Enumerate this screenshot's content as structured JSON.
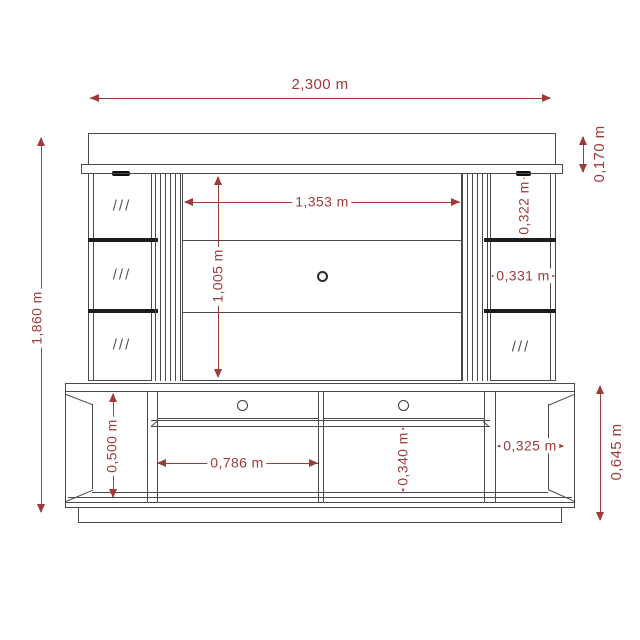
{
  "drawing": {
    "subject": "TV wall unit / entertainment center elevation drawing",
    "units": "m"
  },
  "colors": {
    "dimension": "#9d3a3a",
    "line": "#4a4a4a",
    "shelf_dark": "#1c1c1c",
    "background": "#ffffff"
  },
  "marks": {
    "glass_hatch": "///"
  },
  "dimensions": {
    "total_width": "2,300 m",
    "total_height": "1,860 m",
    "crown_height": "0,170 m",
    "right_upper_section_height": "0,322 m",
    "right_middle_section_width": "0,331 m",
    "panel_width": "1,353 m",
    "panel_height": "1,005 m",
    "cabinet_interior_height": "0,500 m",
    "left_compartment_width": "0,786 m",
    "lower_compartment_height": "0,340 m",
    "right_compartment_width": "0,325 m",
    "cabinet_total_height": "0,645 m"
  }
}
